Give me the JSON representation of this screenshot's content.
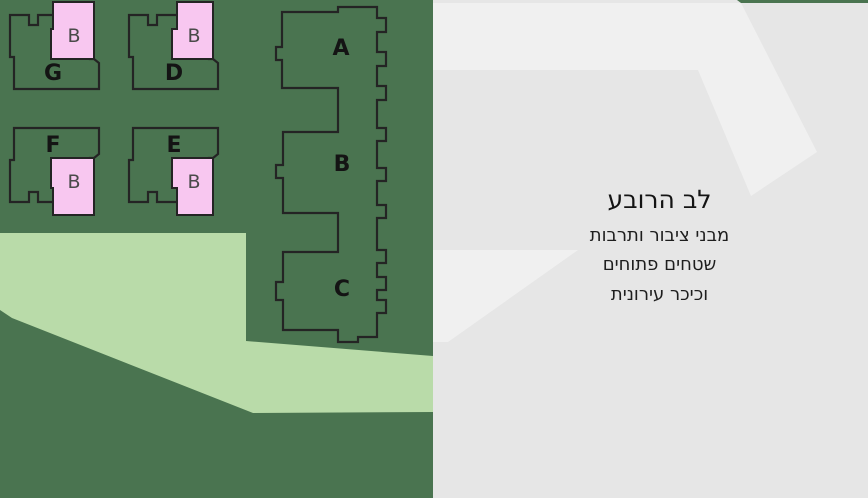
{
  "plan": {
    "courtyard_buildings": [
      {
        "label": "G"
      },
      {
        "label": "D"
      },
      {
        "label": "F"
      },
      {
        "label": "E"
      }
    ],
    "strip_buildings": [
      {
        "label": "A"
      },
      {
        "label": "B"
      },
      {
        "label": "C"
      }
    ],
    "annex_label": "B",
    "colors": {
      "field_green": "#4a7450",
      "park_green": "#b9dba9",
      "annex_pink": "#f8c7f0",
      "outline_dark": "#242424",
      "city_gray": "#e6e6e6",
      "city_light_gray": "#f0f0f0"
    }
  },
  "legend": {
    "title": "לב הרובע",
    "lines": [
      "מבני ציבור ותרבות",
      "שטחים פתוחים",
      "וכיכר עירונית"
    ]
  }
}
